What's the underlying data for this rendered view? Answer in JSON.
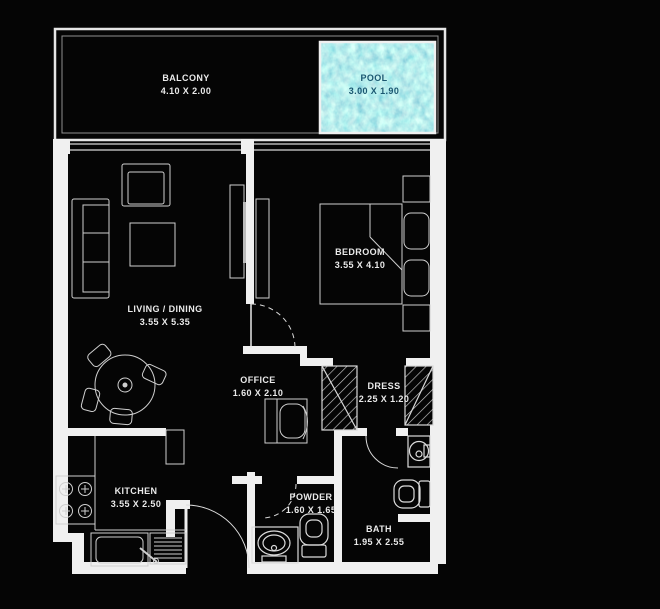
{
  "floorplan": {
    "colors": {
      "background": "#050505",
      "wall": "#f0f0f0",
      "thin_line": "#c9c9c9",
      "pool_water_base": "#38aed4",
      "label_text": "#eaeaea",
      "pool_label_text": "#0d4a66"
    },
    "rooms": {
      "balcony": {
        "name": "BALCONY",
        "dims": "4.10 X 2.00"
      },
      "pool": {
        "name": "POOL",
        "dims": "3.00 X 1.90"
      },
      "living": {
        "name": "LIVING / DINING",
        "dims": "3.55 X 5.35"
      },
      "bedroom": {
        "name": "BEDROOM",
        "dims": "3.55 X 4.10"
      },
      "office": {
        "name": "OFFICE",
        "dims": "1.60 X 2.10"
      },
      "dress": {
        "name": "DRESS",
        "dims": "2.25 X 1.20"
      },
      "kitchen": {
        "name": "KITCHEN",
        "dims": "3.55 X 2.50"
      },
      "powder": {
        "name": "POWDER",
        "dims": "1.60 X 1.65"
      },
      "bath": {
        "name": "BATH",
        "dims": "1.95 X 2.55"
      }
    }
  }
}
